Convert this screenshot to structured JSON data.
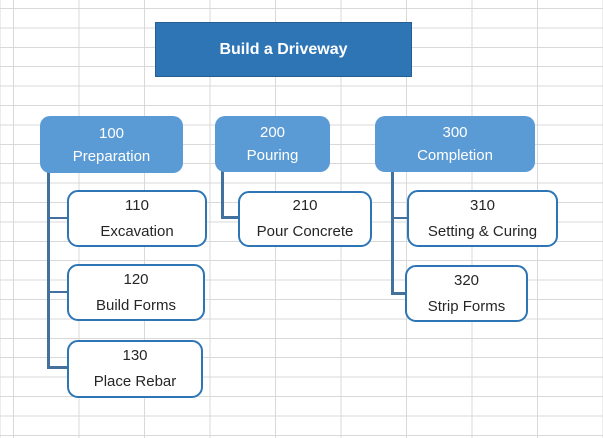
{
  "wbs": {
    "root": {
      "label": "Build a Driveway"
    },
    "branches": [
      {
        "code": "100",
        "label": "Preparation",
        "children": [
          {
            "code": "110",
            "label": "Excavation"
          },
          {
            "code": "120",
            "label": "Build Forms"
          },
          {
            "code": "130",
            "label": "Place Rebar"
          }
        ]
      },
      {
        "code": "200",
        "label": "Pouring",
        "children": [
          {
            "code": "210",
            "label": "Pour Concrete"
          }
        ]
      },
      {
        "code": "300",
        "label": "Completion",
        "children": [
          {
            "code": "310",
            "label": "Setting & Curing"
          },
          {
            "code": "320",
            "label": "Strip Forms"
          }
        ]
      }
    ],
    "colors": {
      "root_fill": "#2E75B6",
      "root_border": "#255E91",
      "branch_fill": "#5B9BD5",
      "task_border": "#2E75B6",
      "task_text": "#262626",
      "text_on_blue": "#FFFFFF",
      "connector": "#41719C",
      "gridline": "#D9D9D9"
    }
  }
}
